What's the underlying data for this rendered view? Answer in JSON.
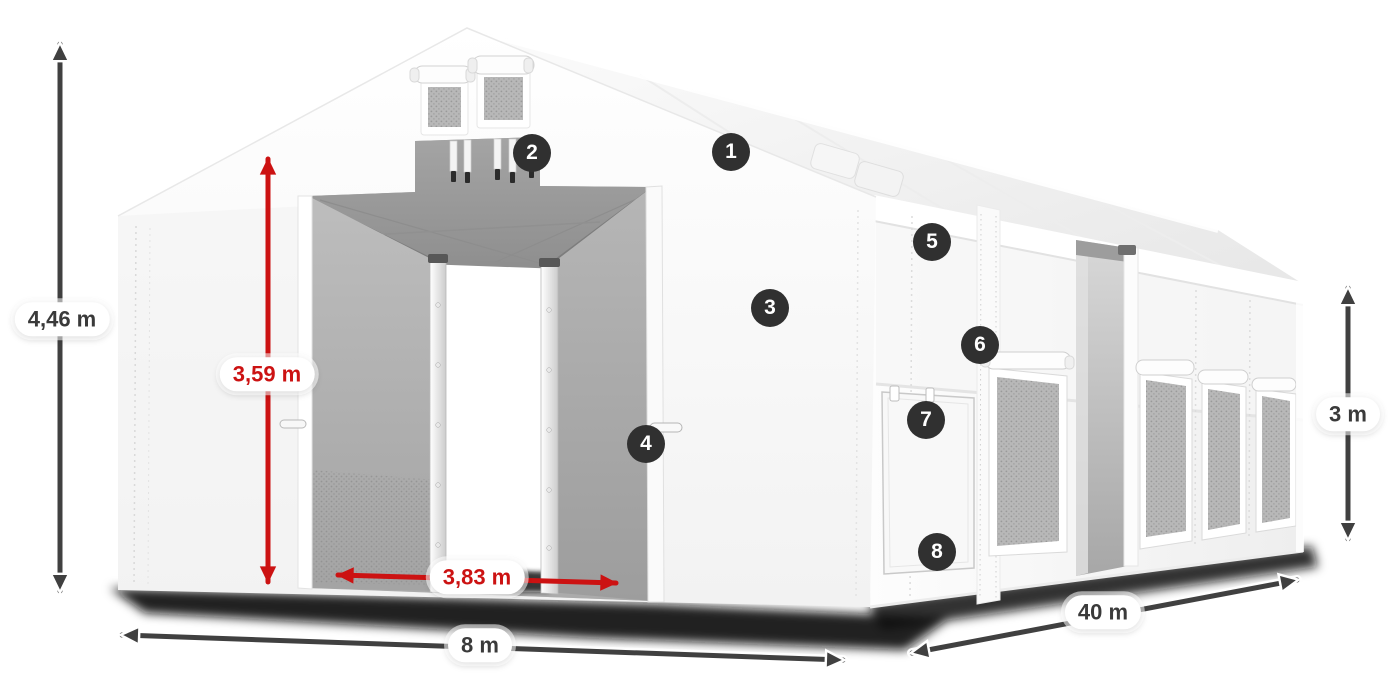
{
  "colors": {
    "dim_dark": "#404040",
    "dim_red": "#cc1212",
    "badge_bg": "#303030",
    "badge_text": "#ffffff",
    "pill_bg": "#ffffff"
  },
  "dimensions": {
    "total_height": {
      "label": "4,46 m"
    },
    "inner_height": {
      "label": "3,59 m"
    },
    "door_width": {
      "label": "3,83 m"
    },
    "width": {
      "label": "8 m"
    },
    "length": {
      "label": "40 m"
    },
    "side_height": {
      "label": "3 m"
    }
  },
  "badges": [
    {
      "number": "1"
    },
    {
      "number": "2"
    },
    {
      "number": "3"
    },
    {
      "number": "4"
    },
    {
      "number": "5"
    },
    {
      "number": "6"
    },
    {
      "number": "7"
    },
    {
      "number": "8"
    }
  ]
}
